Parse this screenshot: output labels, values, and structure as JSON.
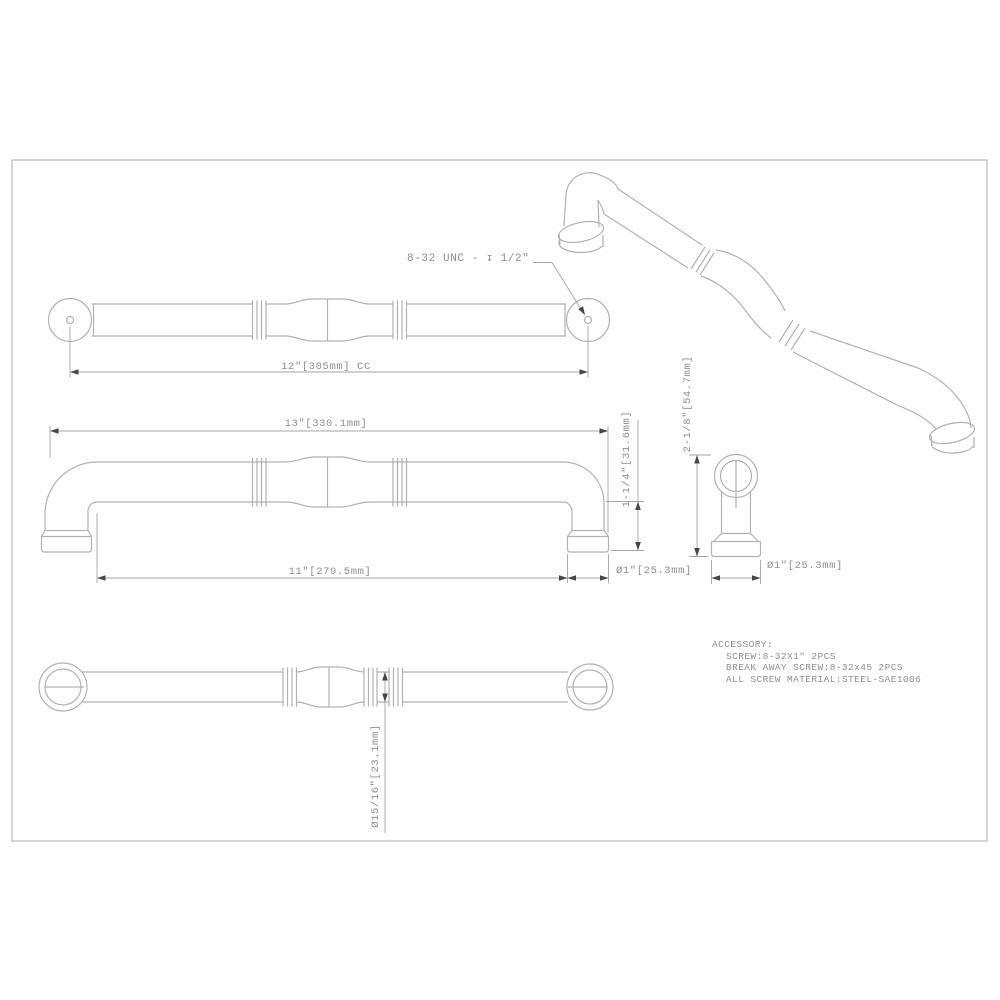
{
  "drawing": {
    "type": "technical-drawing",
    "subject": "cabinet pull handle, multi-view with dimensions",
    "front_view": {
      "thread_note": "8-32 UNC - ↧ 1/2\"",
      "center_to_center": "12\"[305mm] CC"
    },
    "side_view": {
      "overall_length": "13\"[330.1mm]",
      "base_spacing": "11\"[279.5mm]",
      "projection": "1-1/4\"[31.6mm]",
      "base_diameter": "Ø1\"[25.3mm]"
    },
    "end_view": {
      "overall_height": "2-1/8\"[54.7mm]",
      "base_diameter": "Ø1\"[25.3mm]"
    },
    "bottom_view": {
      "grip_diameter": "Ø15/16\"[23.1mm]"
    },
    "accessory": {
      "title": "ACCESSORY:",
      "lines": [
        "SCREW:8-32X1\" 2PCS",
        "BREAK AWAY SCREW:8-32x45 2PCS",
        "ALL SCREW MATERIAL:STEEL-SAE1006"
      ]
    },
    "colors": {
      "background": "#ffffff",
      "part_line": "#b2b2b2",
      "dimension_line": "#a6a6a6",
      "arrow": "#474747",
      "text": "#8f8f8f",
      "border": "#bababa"
    }
  }
}
